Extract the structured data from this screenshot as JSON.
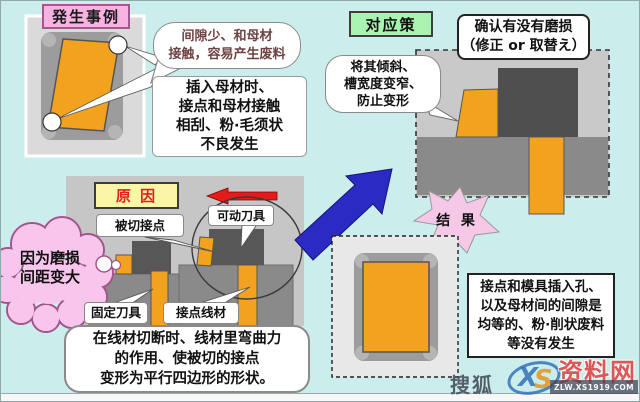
{
  "titles": {
    "case": "発生事例",
    "cause": "原 因",
    "countermeasure": "对应策",
    "result": "结 果"
  },
  "case": {
    "bubble": "间隙少、和母材\n接触，容易产生废料",
    "note": "插入母材时、\n接点和母材接触\n相刮、粉·毛须状\n不良发生"
  },
  "cause": {
    "cloud": "因为磨损\n间距变大",
    "labels": {
      "cut_contact": "被切接点",
      "movable_cutter": "可动刀具",
      "fixed_cutter": "固定刀具",
      "contact_wire": "接点线材"
    },
    "note": "在线材切断时、线材里弯曲力\n的作用、使被切的接点\n变形为平行四边形的形状。"
  },
  "countermeasure": {
    "check": "确认有没有磨损\n（修正 or 取替え）",
    "bubble": "将其倾斜、\n槽宽度变窄、\n防止变形"
  },
  "result": {
    "note": "接点和模具插入孔、\n以及母材间的间隙是\n均等的、粉·削状废料\n等没有发生"
  },
  "watermark": {
    "site": "搜狐",
    "logo_x": "X",
    "logo_s": "S",
    "brand": "资料网",
    "url": "ZLW.XS1919.COM"
  },
  "colors": {
    "background": "#CBEEEC",
    "orange": "#F2A21E",
    "panel_gray": "#C9C9C9",
    "base_gray": "#8A8A8A",
    "tool_gray": "#4F4F4F",
    "case_pink": "#F6B3E2",
    "cause_yellow": "#FAF6A6",
    "cm_green": "#A9F2B0",
    "red_arrow": "#E51A1A",
    "blue_arrow": "#2B2BC4",
    "cloud_pink": "#F8C6EC"
  }
}
